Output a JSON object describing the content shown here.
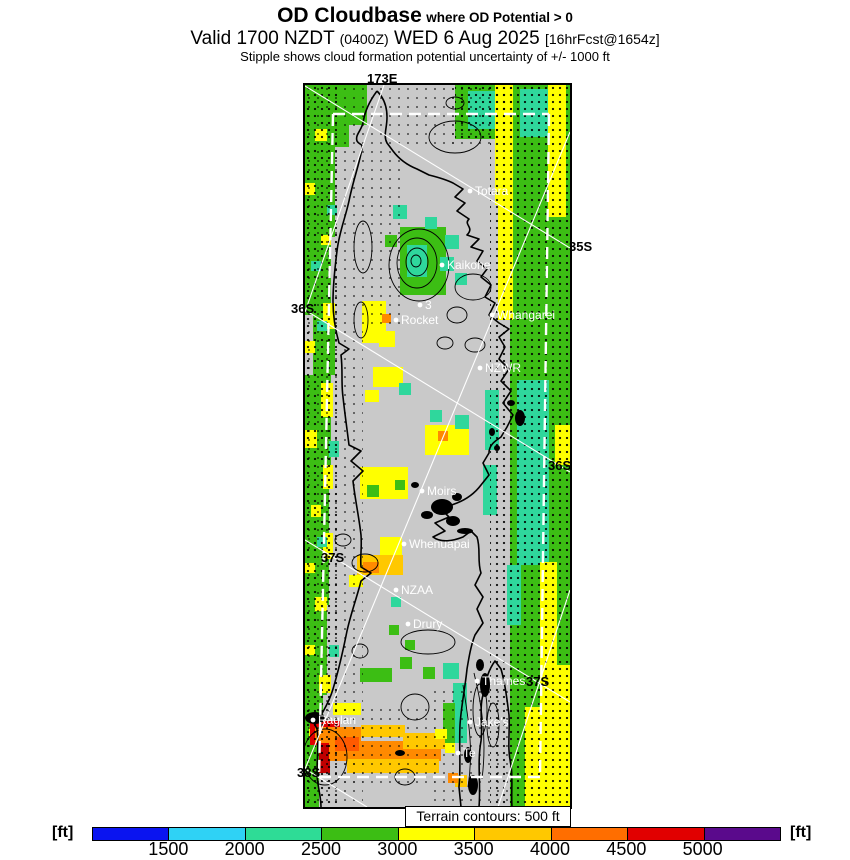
{
  "header": {
    "title_main": "OD Cloudbase",
    "title_qualifier": "where OD Potential > 0",
    "valid_prefix": "Valid 1700 NZDT ",
    "valid_zulu": "(0400Z)",
    "valid_date": " WED 6 Aug 2025 ",
    "valid_fcst": "[16hrFcst@1654z]",
    "stipple_note": "Stipple shows cloud formation potential uncertainty of +/- 1000 ft"
  },
  "map": {
    "terrain_note": "Terrain contours: 500 ft",
    "background": "#c9c9c9",
    "edge_labels": [
      {
        "text": "173E",
        "x": 367,
        "y": 71
      },
      {
        "text": "35S",
        "x": 569,
        "y": 239
      },
      {
        "text": "36S",
        "x": 291,
        "y": 301
      },
      {
        "text": "36S",
        "x": 548,
        "y": 458
      },
      {
        "text": "37S",
        "x": 321,
        "y": 550
      },
      {
        "text": "37S",
        "x": 526,
        "y": 674
      },
      {
        "text": "38S",
        "x": 297,
        "y": 765
      }
    ],
    "cities": [
      {
        "name": "Totara",
        "x": 165,
        "y": 106
      },
      {
        "name": "Kaikohe",
        "x": 137,
        "y": 180
      },
      {
        "name": "3",
        "x": 115,
        "y": 220
      },
      {
        "name": "Rocket",
        "x": 91,
        "y": 235
      },
      {
        "name": "Whangarei",
        "x": 187,
        "y": 230
      },
      {
        "name": "NZWR",
        "x": 175,
        "y": 283
      },
      {
        "name": "Moirs",
        "x": 117,
        "y": 406
      },
      {
        "name": "Whenuapai",
        "x": 99,
        "y": 459
      },
      {
        "name": "NZAA",
        "x": 91,
        "y": 505
      },
      {
        "name": "Drury",
        "x": 103,
        "y": 539
      },
      {
        "name": "Thames",
        "x": 172,
        "y": 596
      },
      {
        "name": "Jake's",
        "x": 165,
        "y": 637
      },
      {
        "name": "Te",
        "x": 153,
        "y": 668
      },
      {
        "name": "Raglan",
        "x": 8,
        "y": 635
      }
    ],
    "palette": {
      "g": "#3cbe14",
      "t": "#2fd79c",
      "y": "#ffff00",
      "go": "#ffc800",
      "o": "#ff8a00",
      "ro": "#ff5a00",
      "r": "#e00000",
      "dr": "#c00000"
    },
    "patches": [
      [
        205,
        0,
        60,
        722,
        "g"
      ],
      [
        0,
        0,
        44,
        62,
        "g"
      ],
      [
        44,
        0,
        18,
        40,
        "g"
      ],
      [
        0,
        62,
        30,
        90,
        "g"
      ],
      [
        0,
        152,
        26,
        78,
        "g"
      ],
      [
        8,
        230,
        22,
        60,
        "g"
      ],
      [
        0,
        290,
        26,
        110,
        "g"
      ],
      [
        0,
        400,
        24,
        120,
        "g"
      ],
      [
        0,
        520,
        22,
        90,
        "g"
      ],
      [
        0,
        610,
        18,
        60,
        "g"
      ],
      [
        0,
        670,
        14,
        52,
        "g"
      ],
      [
        10,
        44,
        12,
        12,
        "y"
      ],
      [
        0,
        98,
        10,
        12,
        "y"
      ],
      [
        16,
        150,
        10,
        10,
        "y"
      ],
      [
        18,
        218,
        12,
        26,
        "y"
      ],
      [
        0,
        256,
        10,
        12,
        "y"
      ],
      [
        16,
        298,
        12,
        34,
        "y"
      ],
      [
        0,
        345,
        12,
        18,
        "y"
      ],
      [
        18,
        380,
        10,
        24,
        "y"
      ],
      [
        6,
        420,
        10,
        12,
        "y"
      ],
      [
        18,
        448,
        10,
        26,
        "y"
      ],
      [
        0,
        478,
        10,
        10,
        "y"
      ],
      [
        10,
        512,
        12,
        14,
        "y"
      ],
      [
        0,
        560,
        10,
        10,
        "y"
      ],
      [
        14,
        590,
        12,
        18,
        "y"
      ],
      [
        4,
        642,
        22,
        10,
        "y"
      ],
      [
        22,
        120,
        10,
        10,
        "t"
      ],
      [
        6,
        176,
        10,
        10,
        "t"
      ],
      [
        24,
        356,
        10,
        16,
        "t"
      ],
      [
        12,
        452,
        10,
        10,
        "t"
      ],
      [
        24,
        560,
        10,
        12,
        "t"
      ],
      [
        12,
        236,
        10,
        10,
        "t"
      ],
      [
        150,
        0,
        58,
        54,
        "g"
      ],
      [
        163,
        6,
        28,
        38,
        "t"
      ],
      [
        190,
        0,
        18,
        120,
        "y"
      ],
      [
        193,
        120,
        15,
        115,
        "y"
      ],
      [
        243,
        0,
        18,
        132,
        "y"
      ],
      [
        215,
        4,
        28,
        48,
        "t"
      ],
      [
        212,
        295,
        32,
        185,
        "t"
      ],
      [
        202,
        480,
        14,
        60,
        "t"
      ],
      [
        235,
        477,
        17,
        148,
        "y"
      ],
      [
        220,
        622,
        45,
        100,
        "y"
      ],
      [
        250,
        580,
        15,
        45,
        "y"
      ],
      [
        250,
        340,
        15,
        40,
        "y"
      ],
      [
        95,
        142,
        46,
        68,
        "g"
      ],
      [
        102,
        160,
        20,
        32,
        "t"
      ],
      [
        88,
        120,
        14,
        14,
        "t"
      ],
      [
        120,
        132,
        12,
        12,
        "t"
      ],
      [
        140,
        150,
        14,
        14,
        "t"
      ],
      [
        80,
        150,
        12,
        12,
        "g"
      ],
      [
        135,
        172,
        14,
        14,
        "t"
      ],
      [
        150,
        188,
        12,
        12,
        "t"
      ],
      [
        57,
        216,
        24,
        42,
        "y"
      ],
      [
        77,
        229,
        9,
        9,
        "o"
      ],
      [
        74,
        246,
        16,
        16,
        "y"
      ],
      [
        68,
        282,
        30,
        20,
        "y"
      ],
      [
        94,
        298,
        12,
        12,
        "t"
      ],
      [
        60,
        305,
        14,
        12,
        "y"
      ],
      [
        120,
        340,
        44,
        30,
        "y"
      ],
      [
        133,
        346,
        10,
        10,
        "o"
      ],
      [
        150,
        330,
        14,
        14,
        "t"
      ],
      [
        125,
        325,
        12,
        12,
        "t"
      ],
      [
        180,
        305,
        14,
        60,
        "t"
      ],
      [
        178,
        380,
        14,
        50,
        "t"
      ],
      [
        55,
        382,
        48,
        32,
        "y"
      ],
      [
        62,
        400,
        12,
        12,
        "g"
      ],
      [
        90,
        395,
        10,
        10,
        "g"
      ],
      [
        75,
        452,
        22,
        20,
        "y"
      ],
      [
        52,
        470,
        46,
        20,
        "go"
      ],
      [
        58,
        477,
        16,
        11,
        "o"
      ],
      [
        44,
        490,
        14,
        12,
        "y"
      ],
      [
        86,
        512,
        10,
        10,
        "t"
      ],
      [
        84,
        540,
        10,
        10,
        "g"
      ],
      [
        100,
        555,
        10,
        10,
        "g"
      ],
      [
        55,
        583,
        32,
        14,
        "g"
      ],
      [
        95,
        572,
        12,
        12,
        "g"
      ],
      [
        118,
        582,
        12,
        12,
        "g"
      ],
      [
        138,
        578,
        16,
        16,
        "t"
      ],
      [
        148,
        598,
        14,
        60,
        "t"
      ],
      [
        138,
        618,
        12,
        44,
        "g"
      ],
      [
        150,
        690,
        12,
        12,
        "go"
      ],
      [
        143,
        688,
        10,
        10,
        "o"
      ],
      [
        28,
        618,
        28,
        12,
        "y"
      ],
      [
        5,
        636,
        30,
        24,
        "r"
      ],
      [
        14,
        660,
        11,
        28,
        "dr"
      ],
      [
        10,
        642,
        46,
        16,
        "o"
      ],
      [
        24,
        656,
        112,
        20,
        "o"
      ],
      [
        42,
        674,
        92,
        14,
        "go"
      ],
      [
        98,
        648,
        42,
        16,
        "go"
      ],
      [
        56,
        640,
        44,
        12,
        "go"
      ],
      [
        30,
        652,
        24,
        14,
        "ro"
      ],
      [
        130,
        644,
        12,
        10,
        "y"
      ],
      [
        140,
        658,
        10,
        10,
        "y"
      ]
    ],
    "stipple_regions": [
      [
        0,
        0,
        150,
        62,
        "s"
      ],
      [
        0,
        62,
        95,
        183,
        "s"
      ],
      [
        0,
        245,
        58,
        477,
        "s"
      ],
      [
        140,
        0,
        50,
        60,
        "s"
      ],
      [
        127,
        600,
        78,
        122,
        "s"
      ],
      [
        10,
        618,
        120,
        86,
        "s"
      ],
      [
        185,
        0,
        80,
        722,
        "d"
      ],
      [
        0,
        0,
        32,
        722,
        "d"
      ],
      [
        150,
        0,
        58,
        54,
        "d"
      ]
    ],
    "contour_ellipses": [
      [
        150,
        52,
        26,
        16
      ],
      [
        114,
        180,
        30,
        36
      ],
      [
        112,
        178,
        20,
        25
      ],
      [
        112,
        177,
        11,
        14
      ],
      [
        111,
        176,
        5,
        6
      ],
      [
        58,
        162,
        9,
        26
      ],
      [
        56,
        235,
        7,
        18
      ],
      [
        168,
        202,
        18,
        13
      ],
      [
        140,
        258,
        8,
        6
      ],
      [
        170,
        260,
        10,
        7
      ],
      [
        152,
        230,
        10,
        8
      ],
      [
        60,
        478,
        13,
        9
      ],
      [
        38,
        455,
        8,
        6
      ],
      [
        123,
        557,
        27,
        12
      ],
      [
        110,
        622,
        14,
        13
      ],
      [
        55,
        566,
        8,
        7
      ],
      [
        20,
        672,
        22,
        28
      ],
      [
        150,
        18,
        9,
        6
      ],
      [
        175,
        625,
        7,
        26
      ],
      [
        188,
        640,
        6,
        22
      ],
      [
        100,
        692,
        10,
        8
      ]
    ],
    "contour_paths": [
      "M158,600 C163,632 169,664 163,702",
      "M169,588 C177,620 182,655 177,694"
    ],
    "coast_paths": [
      "M72,6 C66,14 60,24 58,38 C56,46 50,50 52,56 C54,60 58,58 57,64 C54,80 48,96 44,116 C40,134 34,148 32,166 C30,182 28,200 28,216 C28,228 30,244 34,258 L44,264 L36,270 C38,286 36,298 38,312 C40,330 42,344 44,360 L56,366 L46,376 L58,386 L48,396 C50,414 54,432 56,450 C57,464 55,472 56,482 L66,488 L56,496 C52,512 46,528 42,546 C38,566 34,584 28,604 C24,618 18,626 14,634 L6,632 L12,644 C14,658 12,672 12,688 C12,700 16,710 16,722",
      "M72,6 C78,12 82,20 82,32 C82,44 78,50 82,58 L88,66 C94,74 102,80 112,84 L124,90 C132,92 140,94 148,98 L158,104 L150,112 L160,118 L152,126 L164,134 C158,140 170,142 162,150 L174,154 L166,162 L178,166 L172,176 L182,184 L176,192 L186,200 L180,212 L190,218 L184,230 L194,238 L204,244 L194,252 L200,262 L194,274 L204,284 L196,296 L206,306 L198,318 L208,330 L202,342 L196,352 C190,356 184,360 184,368 L178,378 L184,390 L176,400 C170,408 162,414 152,418 L136,424 L144,432 L130,438 L140,446 L128,452 C136,458 148,456 158,452 L166,446 L172,452 C176,464 172,476 176,488 L170,500 L178,512 L172,524 L178,538 L170,550 C166,560 164,572 162,584 C160,604 156,622 155,640 C154,662 156,682 154,702 L156,722",
      "M174,722 C176,700 172,678 176,656 C178,640 174,624 178,610 C180,596 184,584 190,576 L196,584 C200,598 202,614 204,630 C205,648 202,664 206,680 C208,694 206,708 207,722"
    ],
    "blobs": [
      [
        10,
        633,
        10,
        6
      ],
      [
        206,
        318,
        4,
        3
      ],
      [
        215,
        333,
        5,
        8
      ],
      [
        192,
        363,
        3,
        3
      ],
      [
        187,
        347,
        3,
        4
      ],
      [
        160,
        446,
        8,
        3
      ],
      [
        137,
        422,
        11,
        8
      ],
      [
        148,
        436,
        7,
        5
      ],
      [
        122,
        430,
        6,
        4
      ],
      [
        152,
        412,
        5,
        4
      ],
      [
        110,
        400,
        4,
        3
      ],
      [
        168,
        700,
        5,
        10
      ],
      [
        163,
        670,
        4,
        8
      ],
      [
        95,
        668,
        5,
        3
      ],
      [
        180,
        600,
        5,
        12
      ],
      [
        175,
        580,
        4,
        6
      ]
    ],
    "dashed_lines": [
      [
        28,
        29,
        244,
        29
      ],
      [
        28,
        29,
        14,
        692
      ],
      [
        244,
        29,
        235,
        692
      ],
      [
        14,
        692,
        235,
        692
      ]
    ],
    "solid_lines": [
      [
        0,
        1,
        265,
        163
      ],
      [
        0,
        225,
        265,
        387
      ],
      [
        0,
        455,
        265,
        617
      ],
      [
        0,
        684,
        62,
        722
      ],
      [
        79,
        0,
        0,
        227
      ],
      [
        265,
        47,
        0,
        684
      ],
      [
        265,
        505,
        193,
        722
      ]
    ]
  },
  "colorbar": {
    "unit_label": "[ft]",
    "ticks": [
      "1500",
      "2000",
      "2500",
      "3000",
      "3500",
      "4000",
      "4500",
      "5000"
    ],
    "colors": [
      "#0a14f0",
      "#2fd2f5",
      "#2edc96",
      "#3cbe14",
      "#ffff00",
      "#ffc800",
      "#ff6e00",
      "#e10000",
      "#5a0a8c"
    ]
  }
}
